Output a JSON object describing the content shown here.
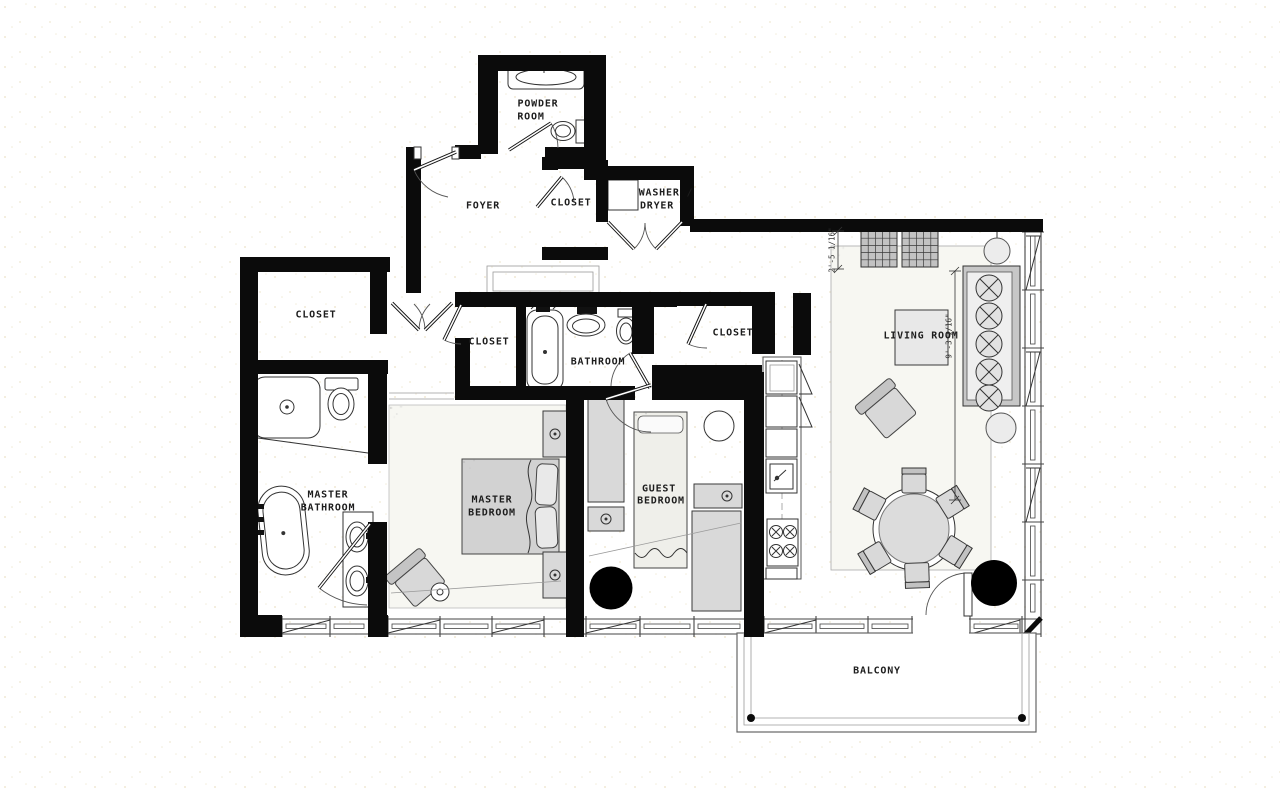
{
  "drawing": {
    "type": "apartment floor plan",
    "colors": {
      "wall": "#0b0b0b",
      "linework": "#333333",
      "furniture_fill": "#d9d9d9",
      "carpet_fill": "#f6f6f1"
    }
  },
  "labels": {
    "powder_room_line1": "POWDER",
    "powder_room_line2": "ROOM",
    "foyer": "FOYER",
    "closet_foyer": "CLOSET",
    "washer_dryer_line1": "WASHER /",
    "washer_dryer_line2": "DRYER",
    "closet_master": "CLOSET",
    "closet_hall": "CLOSET",
    "bathroom": "BATHROOM",
    "closet_guest": "CLOSET",
    "master_bathroom_line1": "MASTER",
    "master_bathroom_line2": "BATHROOM",
    "master_bedroom_line1": "MASTER",
    "master_bedroom_line2": "BEDROOM",
    "guest_bedroom_line1": "GUEST",
    "guest_bedroom_line2": "BEDROOM",
    "living_room": "LIVING ROOM",
    "balcony": "BALCONY"
  },
  "dimensions": {
    "living_area_width": "2'-5 1/16\"",
    "living_area_length": "9'-3 1/16\""
  }
}
